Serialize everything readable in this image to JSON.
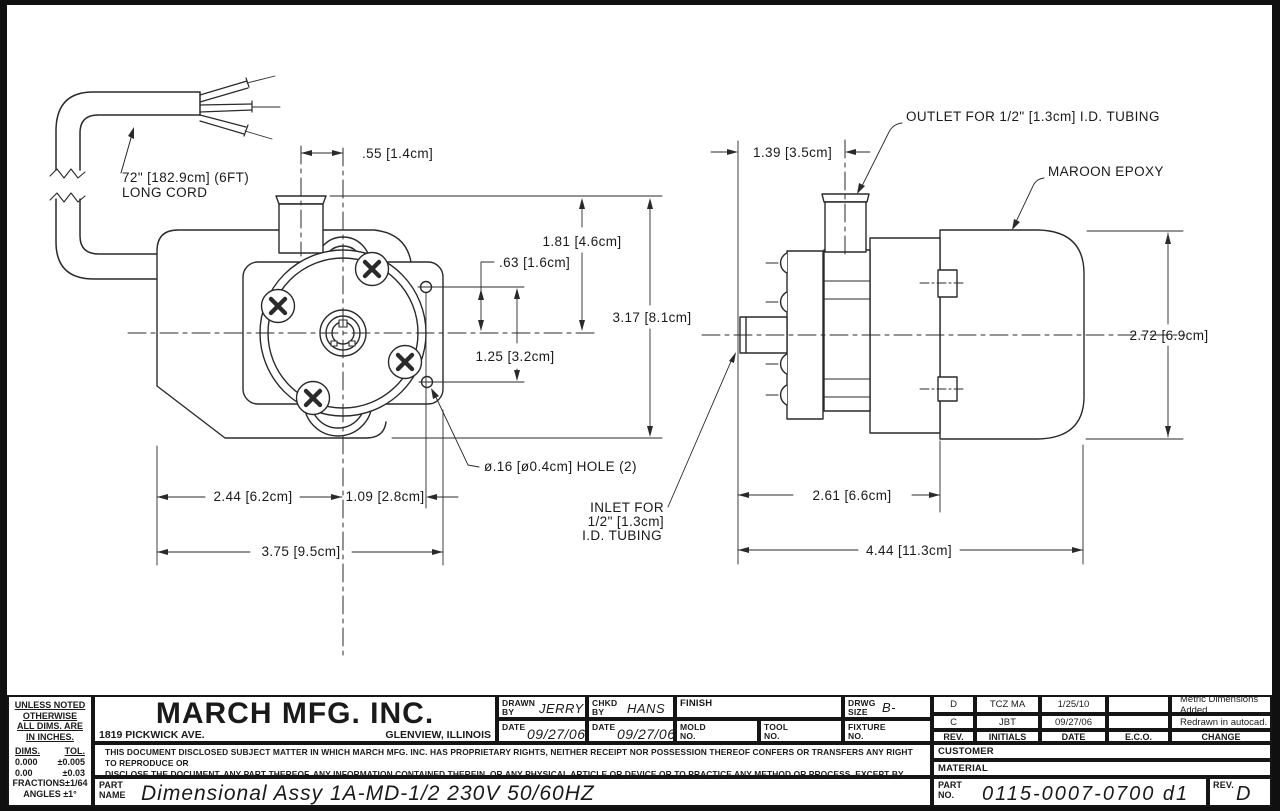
{
  "drawing": {
    "cord_note_line1": "72\" [182.9cm] (6FT)",
    "cord_note_line2": "LONG CORD",
    "front_view": {
      "dim_port_offset": ".55 [1.4cm]",
      "dim_port_height": "1.81 [4.6cm]",
      "dim_hole_above_center": ".63 [1.6cm]",
      "dim_overall_height": "3.17 [8.1cm]",
      "dim_hole_spacing": "1.25 [3.2cm]",
      "dim_center_from_left": "2.44 [6.2cm]",
      "dim_hole_from_center": "1.09 [2.8cm]",
      "dim_overall_width": "3.75 [9.5cm]",
      "note_mounting_hole": "ø.16 [ø0.4cm] HOLE (2)"
    },
    "side_view": {
      "note_outlet": "OUTLET FOR 1/2\" [1.3cm] I.D. TUBING",
      "note_epoxy": "MAROON EPOXY",
      "dim_outlet_offset": "1.39 [3.5cm]",
      "dim_overall_height": "2.72 [6.9cm]",
      "note_inlet_line1": "INLET FOR",
      "note_inlet_line2": "1/2\" [1.3cm]",
      "note_inlet_line3": "I.D. TUBING",
      "dim_body_length": "2.61 [6.6cm]",
      "dim_overall_length": "4.44 [11.3cm]"
    }
  },
  "title_block": {
    "tol_note_1": "UNLESS NOTED",
    "tol_note_2": "OTHERWISE",
    "tol_note_3": "ALL DIMS. ARE",
    "tol_note_4": "IN INCHES.",
    "tol_dims_header": "DIMS.",
    "tol_tol_header": "TOL.",
    "tol_row1_dims": "0.000",
    "tol_row1_tol": "±0.005",
    "tol_row2_dims": "0.00",
    "tol_row2_tol": "±0.03",
    "tol_fractions": "FRACTIONS±1/64",
    "tol_angles": "ANGLES  ±1°",
    "company": {
      "name": "MARCH MFG. INC.",
      "address": "1819 PICKWICK AVE.",
      "city": "GLENVIEW, ILLINOIS"
    },
    "drawn_by_label": "DRAWN BY",
    "drawn_by": "JERRY",
    "drawn_date_label": "DATE",
    "drawn_date": "09/27/06",
    "chkd_by_label": "CHKD BY",
    "chkd_by": "HANS",
    "chkd_date_label": "DATE",
    "chkd_date": "09/27/06",
    "finish_label": "FINISH",
    "mold_label": "MOLD NO.",
    "tool_label": "TOOL NO.",
    "drwg_size_label": "DRWG SIZE",
    "drwg_size": "B-11x17",
    "fixture_label": "FIXTURE NO.",
    "disclaimer_line1": "THIS DOCUMENT DISCLOSED SUBJECT MATTER IN WHICH MARCH MFG. INC. HAS PROPRIETARY RIGHTS, NEITHER RECEIPT NOR POSSESSION THEREOF CONFERS OR TRANSFERS ANY RIGHT TO REPRODUCE OR",
    "disclaimer_line2": "DISCLOSE THE DOCUMENT, ANY PART THEREOF, ANY INFORMATION CONTAINED THEREIN, OR ANY PHYSICAL ARTICLE OR DEVICE OR TO PRACTICE ANY METHOD OR PROCESS, EXCEPT BY WRITTEN PERMISSION",
    "disclaimer_line3": "FROM OR WRITTEN AGREEMENT WITH MARCH MFG. INC.",
    "revisions": {
      "header": {
        "rev": "REV.",
        "initials": "INITIALS",
        "date": "DATE",
        "eco": "E.C.O.",
        "change": "CHANGE"
      },
      "rows": [
        {
          "rev": "D",
          "initials": "TCZ MA",
          "date": "1/25/10",
          "eco": "",
          "change": "Metric Dimensions Added."
        },
        {
          "rev": "C",
          "initials": "JBT",
          "date": "09/27/06",
          "eco": "",
          "change": "Redrawn in autocad."
        }
      ]
    },
    "customer_label": "CUSTOMER",
    "material_label": "MATERIAL",
    "part_name_label_1": "PART",
    "part_name_label_2": "NAME",
    "part_name": "Dimensional Assy 1A-MD-1/2 230V 50/60HZ",
    "part_no_label_1": "PART",
    "part_no_label_2": "NO.",
    "part_no": "0115-0007-0700 d1",
    "rev_label": "REV.",
    "rev": "D"
  }
}
